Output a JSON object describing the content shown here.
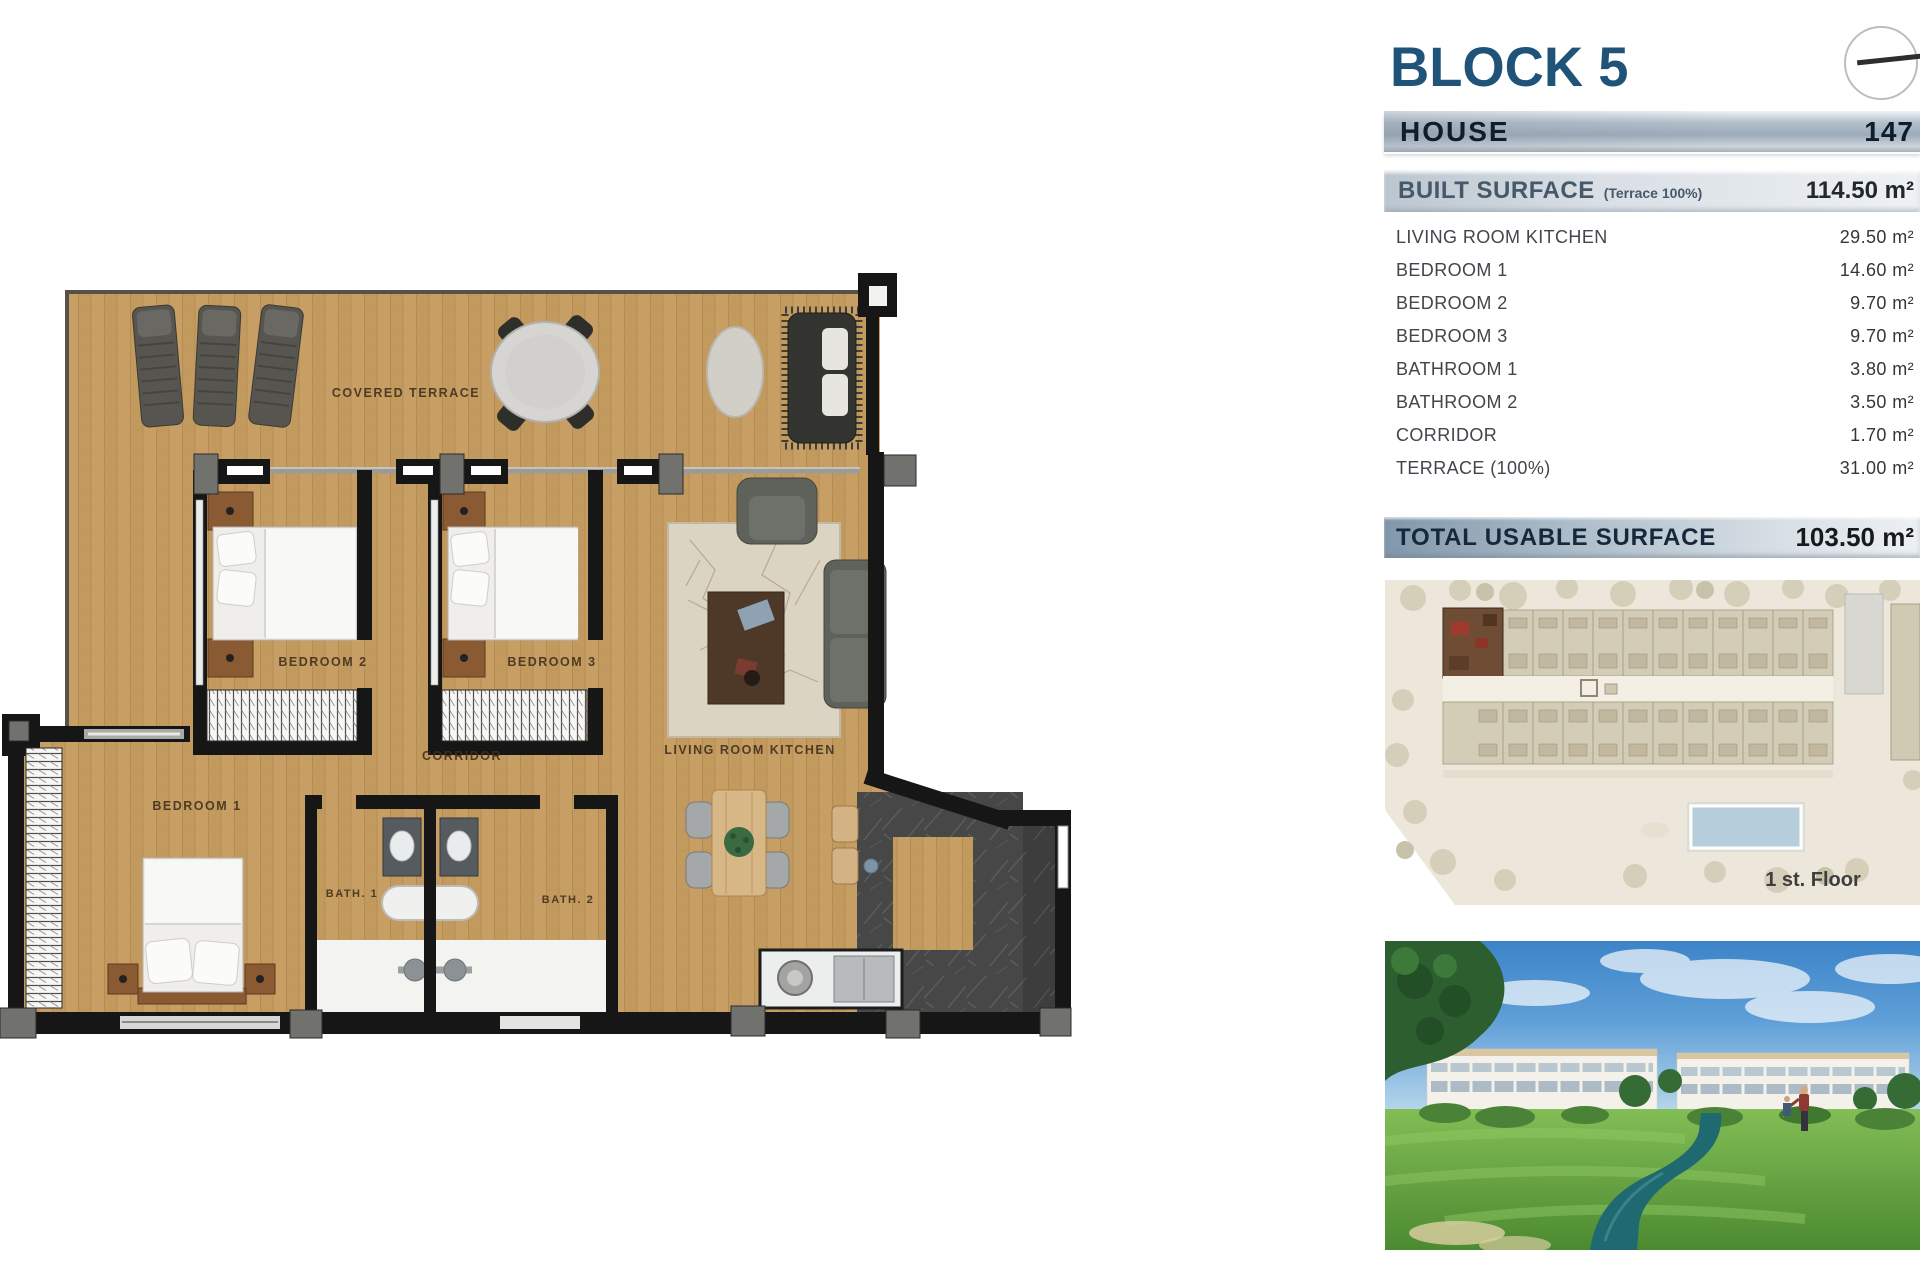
{
  "panel": {
    "block_title": "BLOCK 5",
    "house": {
      "label": "HOUSE",
      "number": "147"
    },
    "built": {
      "label": "BUILT SURFACE",
      "note": "(Terrace 100%)",
      "value": "114.50 m²"
    },
    "rooms": [
      {
        "label": "LIVING ROOM KITCHEN",
        "value": "29.50 m²"
      },
      {
        "label": "BEDROOM 1",
        "value": "14.60 m²"
      },
      {
        "label": "BEDROOM 2",
        "value": "9.70 m²"
      },
      {
        "label": "BEDROOM 3",
        "value": "9.70 m²"
      },
      {
        "label": "BATHROOM 1",
        "value": "3.80 m²"
      },
      {
        "label": "BATHROOM 2",
        "value": "3.50 m²"
      },
      {
        "label": "CORRIDOR",
        "value": "1.70 m²"
      },
      {
        "label": "TERRACE (100%)",
        "value": "31.00 m²"
      }
    ],
    "total": {
      "label": "TOTAL USABLE SURFACE",
      "value": "103.50 m²"
    },
    "site_plan": {
      "floor_label": "1 st. Floor"
    }
  },
  "floorplan": {
    "labels": {
      "covered_terrace": "COVERED TERRACE",
      "bedroom_1": "BEDROOM 1",
      "bedroom_2": "BEDROOM 2",
      "bedroom_3": "BEDROOM 3",
      "corridor": "CORRIDOR",
      "living_room_kitchen": "LIVING ROOM KITCHEN",
      "bath_1": "BATH. 1",
      "bath_2": "BATH. 2"
    }
  },
  "colors": {
    "accent_blue": "#1f5378",
    "bar_text_dark": "#0d1d2b",
    "bar_text_slate": "#46596b",
    "wood": "#c79e63",
    "wall": "#161616",
    "pool": "#b6cedb",
    "river": "#1e6a70"
  }
}
